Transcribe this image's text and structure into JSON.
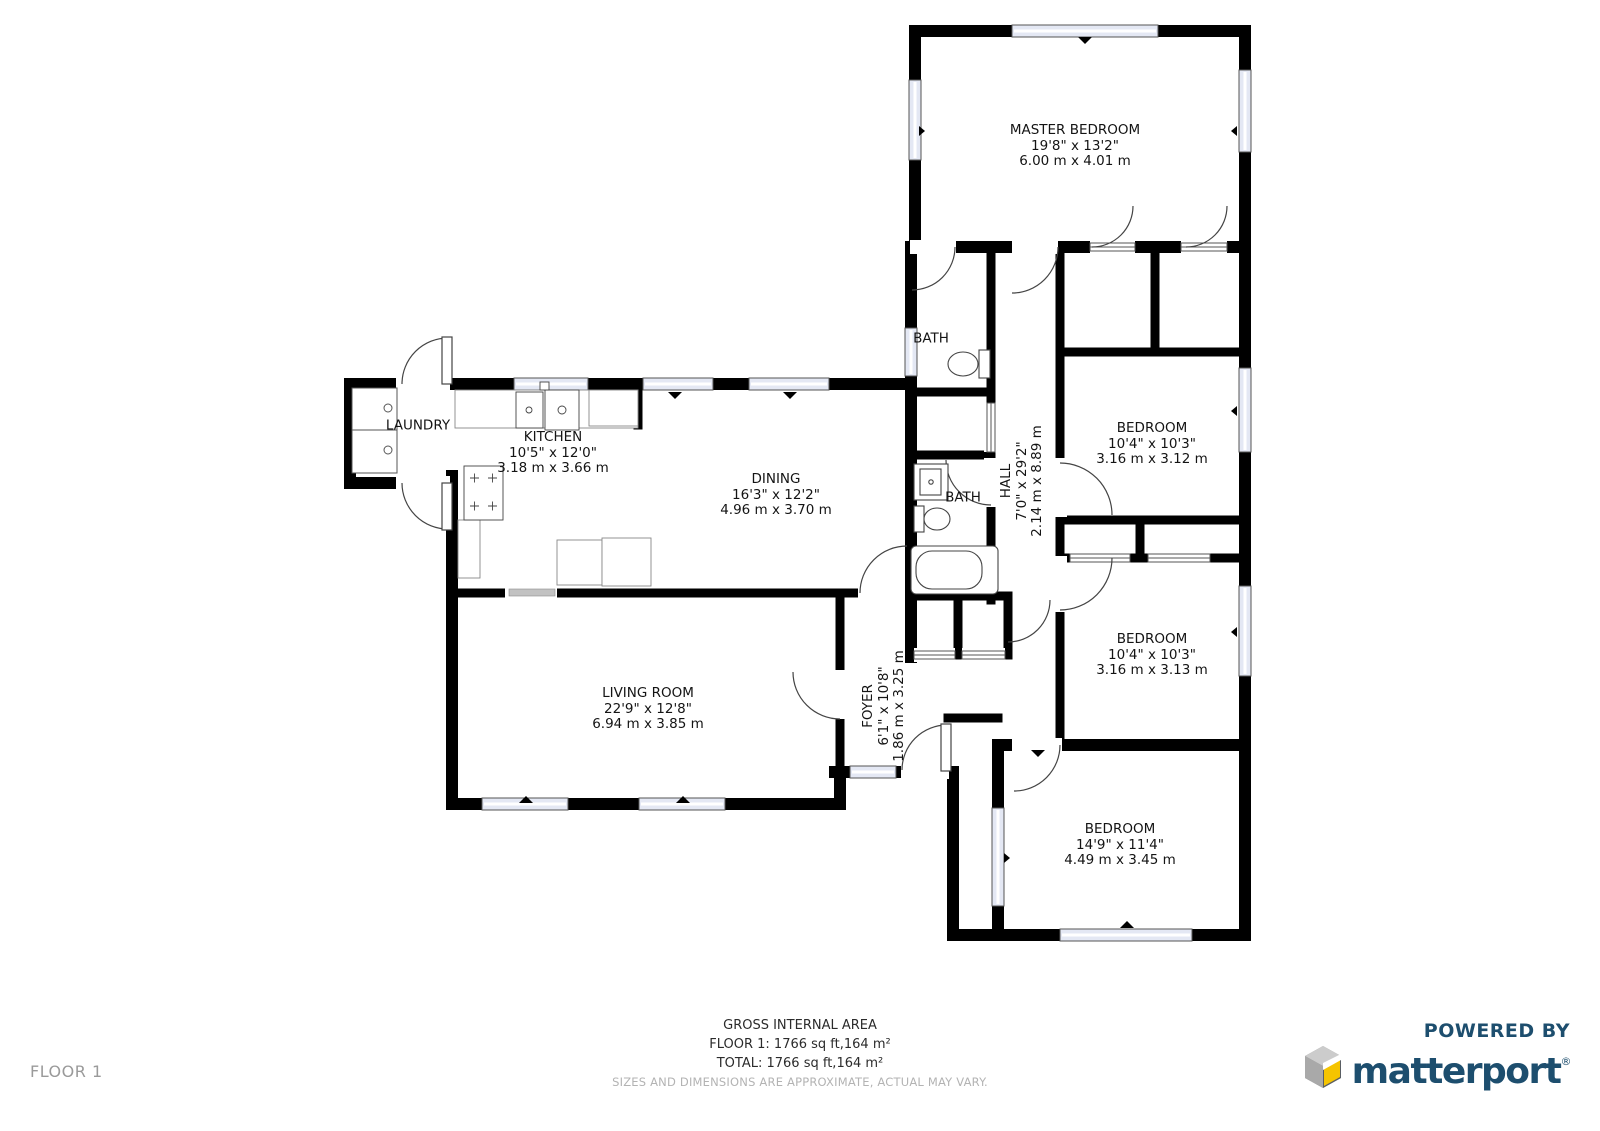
{
  "rooms": [
    {
      "id": "master-bedroom",
      "name": "MASTER BEDROOM",
      "imperial": "19'8\" x 13'2\"",
      "metric": "6.00 m x 4.01 m"
    },
    {
      "id": "kitchen",
      "name": "KITCHEN",
      "imperial": "10'5\" x 12'0\"",
      "metric": "3.18 m x 3.66 m"
    },
    {
      "id": "dining",
      "name": "DINING",
      "imperial": "16'3\" x 12'2\"",
      "metric": "4.96 m x 3.70 m"
    },
    {
      "id": "living-room",
      "name": "LIVING ROOM",
      "imperial": "22'9\" x 12'8\"",
      "metric": "6.94 m x 3.85 m"
    },
    {
      "id": "bedroom-1",
      "name": "BEDROOM",
      "imperial": "10'4\" x 10'3\"",
      "metric": "3.16 m x 3.12 m"
    },
    {
      "id": "bedroom-2",
      "name": "BEDROOM",
      "imperial": "10'4\" x 10'3\"",
      "metric": "3.16 m x 3.13 m"
    },
    {
      "id": "bedroom-3",
      "name": "BEDROOM",
      "imperial": "14'9\" x 11'4\"",
      "metric": "4.49 m x 3.45 m"
    },
    {
      "id": "hall",
      "name": "HALL",
      "imperial": "7'0\" x 29'2\"",
      "metric": "2.14 m x 8.89 m"
    },
    {
      "id": "foyer",
      "name": "FOYER",
      "imperial": "6'1\" x 10'8\"",
      "metric": "1.86 m x 3.25 m"
    },
    {
      "id": "laundry",
      "name": "LAUNDRY"
    },
    {
      "id": "bath-upper",
      "name": "BATH"
    },
    {
      "id": "bath-lower",
      "name": "BATH"
    }
  ],
  "footer": {
    "gross_label": "GROSS INTERNAL AREA",
    "floor_line": "FLOOR 1: 1766 sq ft,164 m²",
    "total_line": "TOTAL: 1766 sq ft,164 m²",
    "disclaimer": "SIZES AND DIMENSIONS ARE APPROXIMATE, ACTUAL MAY VARY.",
    "floor_label": "FLOOR 1"
  },
  "branding": {
    "powered_by": "POWERED BY",
    "name": "matterport",
    "registered": "®"
  },
  "colors": {
    "wall": "#000000",
    "window_tint": "#e4e8f4",
    "brand_navy": "#1d4e6e",
    "cube_yellow": "#f5c400",
    "cube_gray_light": "#cccccc",
    "cube_gray_dark": "#919191",
    "muted_text": "#b3b3b3"
  }
}
